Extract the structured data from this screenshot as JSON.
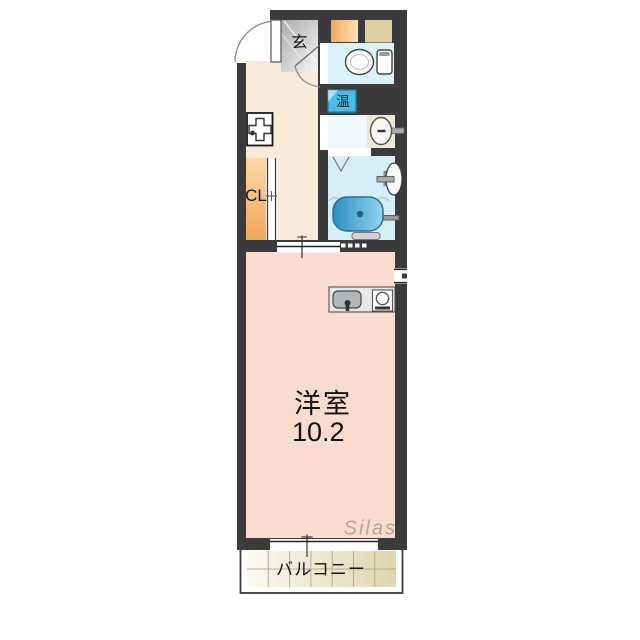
{
  "floorplan": {
    "labels": {
      "entrance": "玄",
      "water_heater": "温",
      "closet": "CL",
      "room_name": "洋室",
      "room_size": "10.2",
      "balcony": "バルコニー",
      "watermark": "Silas"
    },
    "colors": {
      "wall": "#3b3b3b",
      "hallway_floor": "#f9ead9",
      "room_floor": "#fadbcf",
      "closet_a": "#f8d8a6",
      "closet_b": "#f1a75e",
      "genkan_a": "#ababab",
      "genkan_b": "#f5f5f5",
      "toilet_floor": "#dbf2fb",
      "washroom_floor": "#eef7fa",
      "bathroom_floor": "#d6eef8",
      "vanity_floor": "#efe8d8",
      "storage_a": "#f3a95e",
      "storage_b": "#fbe0b4",
      "storage_tan": "#dccfa2",
      "heater_box": "#4cbce8",
      "heater_border": "#2a7ca8",
      "bathtub_a": "#2f8ec0",
      "bathtub_b": "#8fd5ed",
      "balcony_tile_a": "#fbf9f0",
      "balcony_tile_b": "#e0d5ae",
      "counter": "#e8e8e8",
      "sink": "#b2b6b9",
      "watermark_color": "#a39d94"
    }
  }
}
